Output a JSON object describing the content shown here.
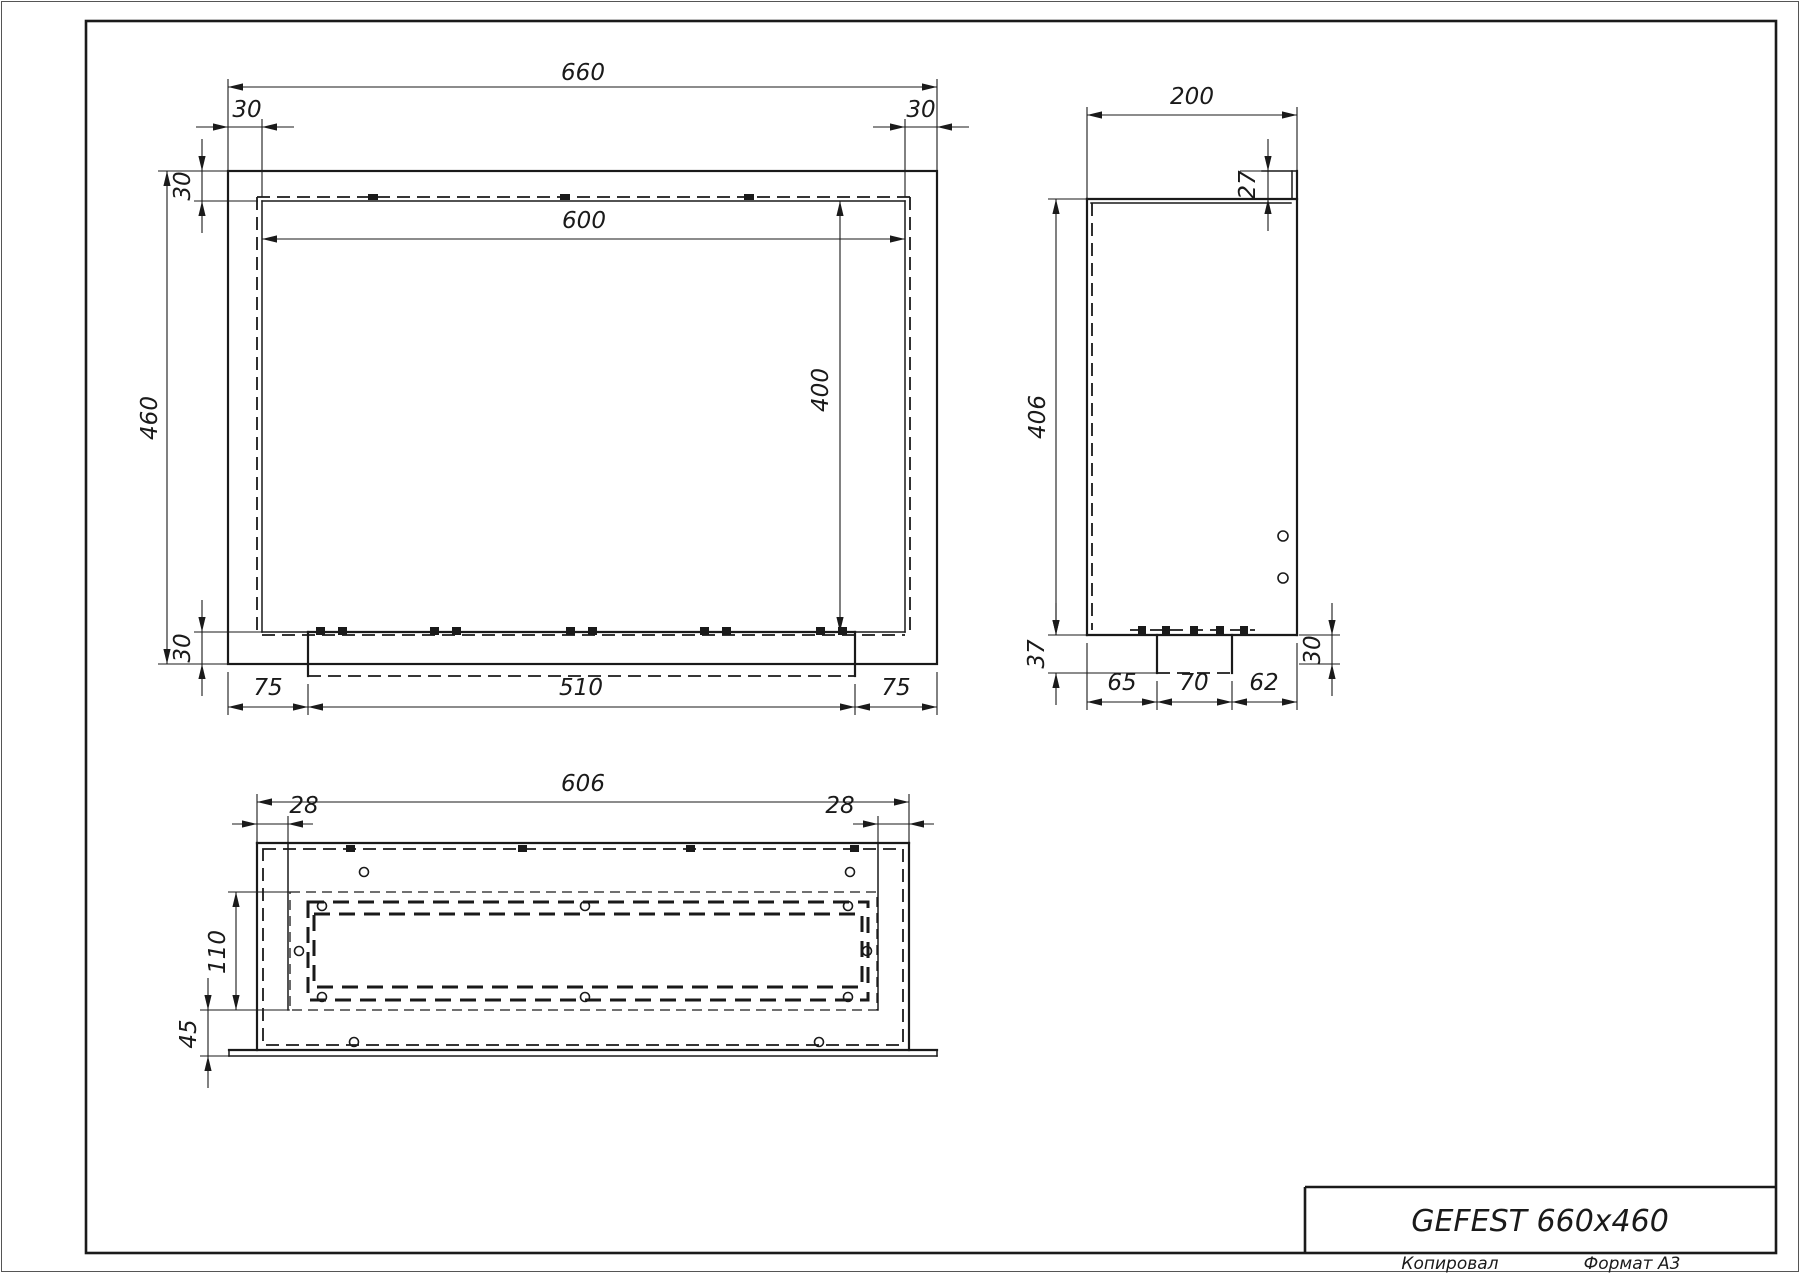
{
  "title_block": {
    "title": "GEFEST 660x460"
  },
  "sheet": {
    "copied_label": "Копировал",
    "format_label": "Формат А3"
  },
  "dims": {
    "front": {
      "overall_width": "660",
      "overall_height": "460",
      "flange_left": "30",
      "flange_right": "30",
      "flange_top": "30",
      "opening_width": "600",
      "opening_height": "400",
      "bottom_band": "30",
      "tray_margin_left": "75",
      "tray_width": "510",
      "tray_margin_right": "75"
    },
    "side": {
      "depth": "200",
      "lip_height": "27",
      "body_height": "406",
      "tray_depth": "37",
      "front_segment": "65",
      "tray_slot": "70",
      "rear_segment": "62",
      "rear_drop": "30"
    },
    "bottom": {
      "panel_width": "606",
      "offset_left": "28",
      "offset_right": "28",
      "slot_region_depth": "110",
      "front_margin": "45"
    }
  },
  "colors": {
    "line": "#1a1a1a",
    "background": "#ffffff"
  }
}
